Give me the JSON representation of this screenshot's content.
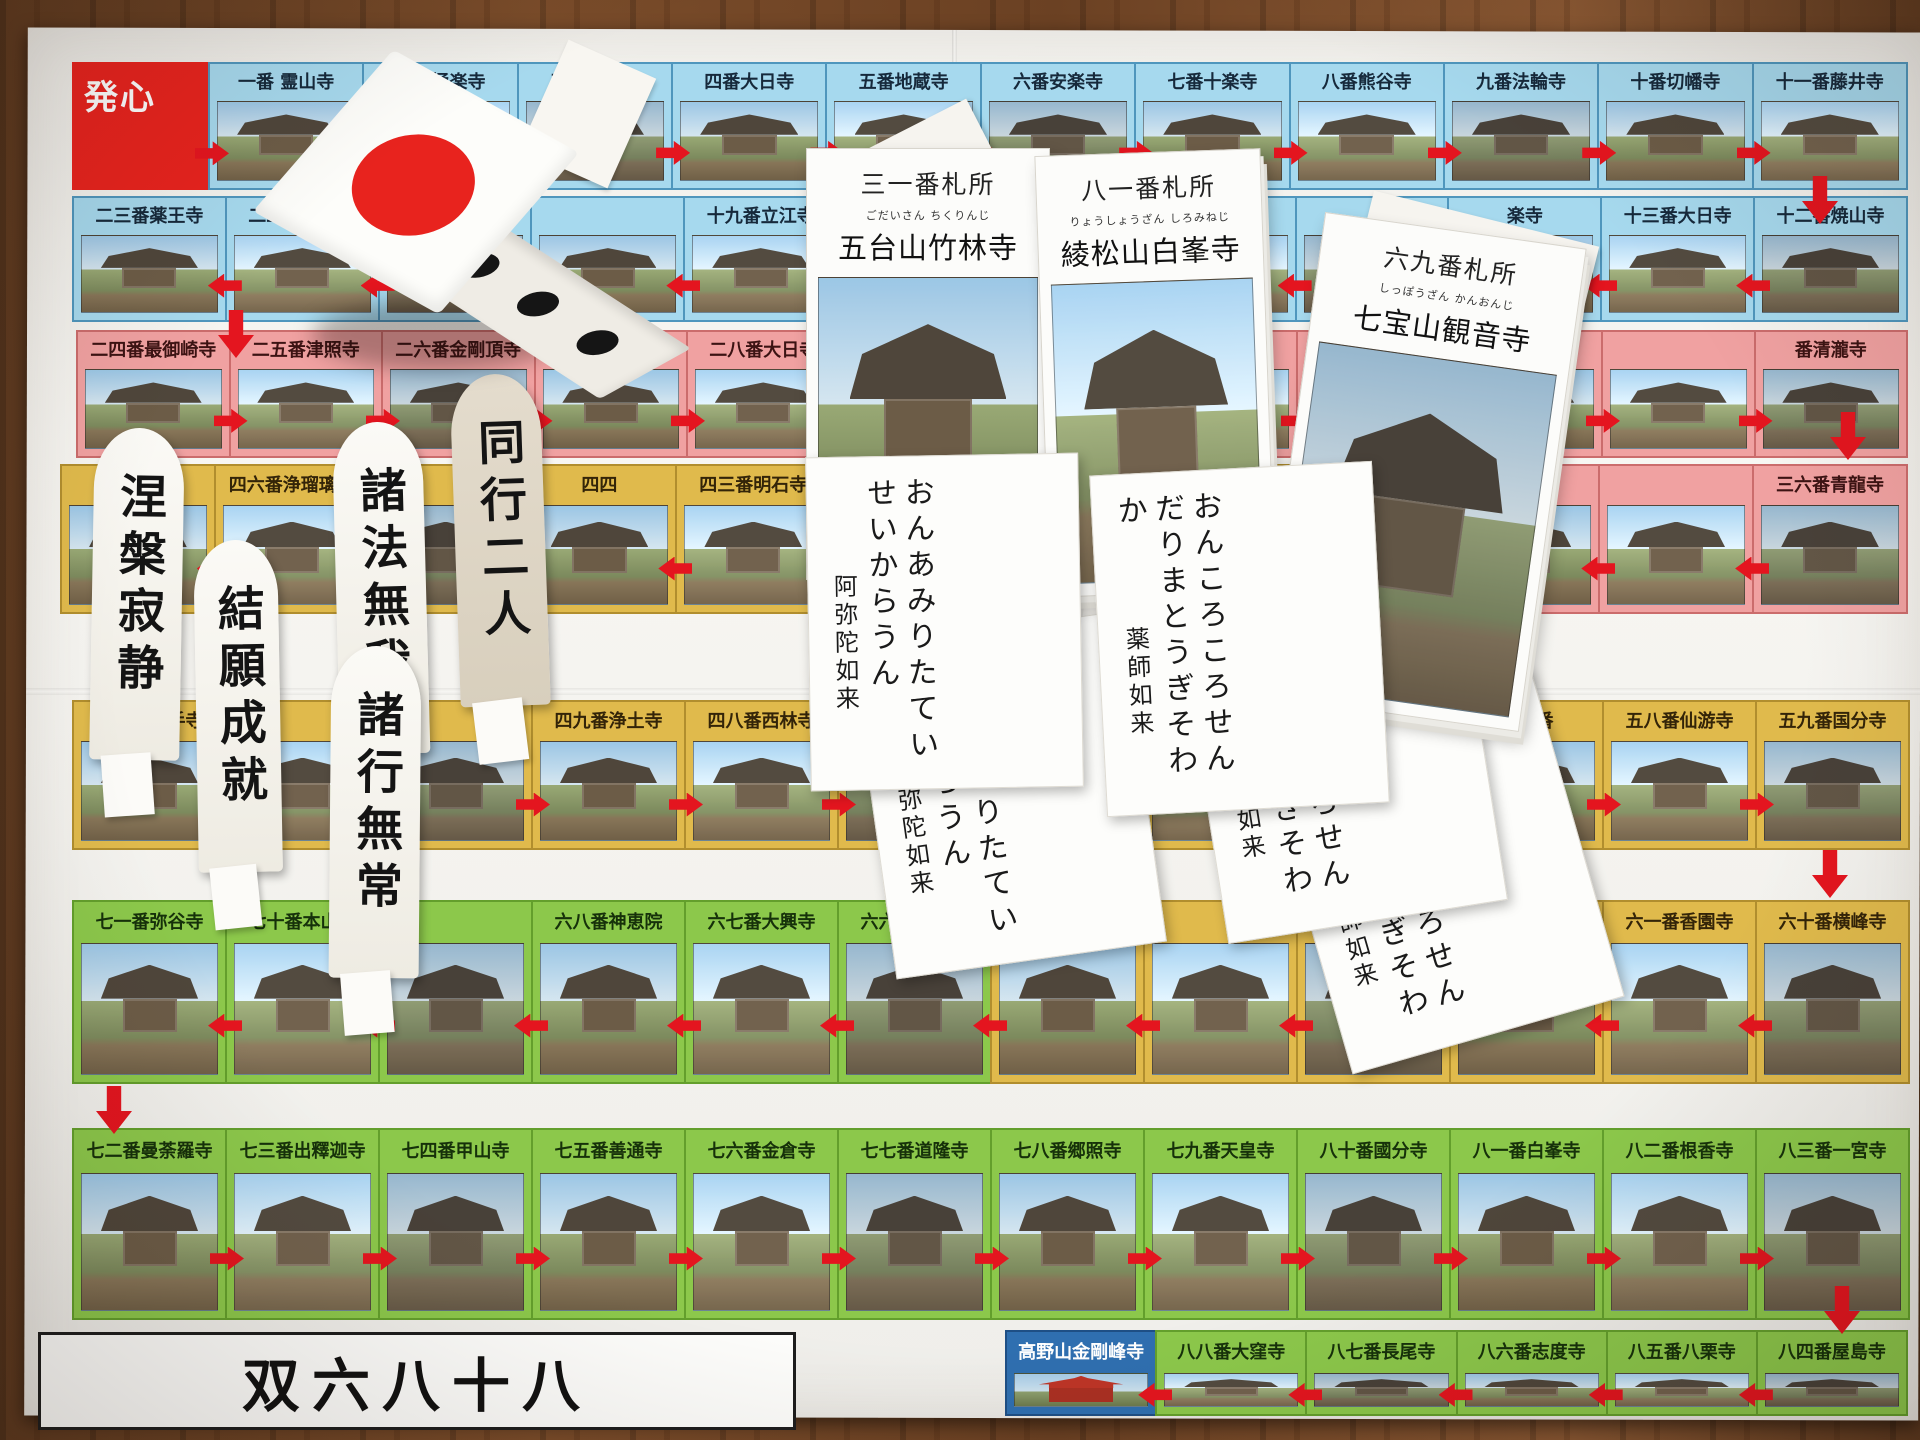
{
  "scene": {
    "board_title": "双六八十八",
    "start_label": "発心",
    "goal_label": "高野山金剛峰寺"
  },
  "rows": [
    {
      "name": "row-1",
      "zone": "blue",
      "dir": "right",
      "cells": [
        {
          "t": "一番 霊山寺"
        },
        {
          "t": "二番極楽寺"
        },
        {
          "t": "三番金泉寺"
        },
        {
          "t": "四番大日寺"
        },
        {
          "t": "五番地蔵寺"
        },
        {
          "t": "六番安楽寺"
        },
        {
          "t": "七番十楽寺"
        },
        {
          "t": "八番熊谷寺"
        },
        {
          "t": "九番法輪寺"
        },
        {
          "t": "十番切幡寺"
        },
        {
          "t": "十一番藤井寺"
        }
      ]
    },
    {
      "name": "row-2",
      "zone": "blue",
      "dir": "left",
      "cells": [
        {
          "t": "二三番薬王寺"
        },
        {
          "t": "二二番平等寺"
        },
        {
          "t": ""
        },
        {
          "t": ""
        },
        {
          "t": "十九番立江寺"
        },
        {
          "t": "十八番恩山寺"
        },
        {
          "t": ""
        },
        {
          "t": ""
        },
        {
          "t": ""
        },
        {
          "t": "楽寺"
        },
        {
          "t": "十三番大日寺"
        },
        {
          "t": "十二番焼山寺"
        }
      ]
    },
    {
      "name": "row-3",
      "zone": "pink",
      "dir": "right",
      "cells": [
        {
          "t": "二四番最御崎寺"
        },
        {
          "t": "二五番津照寺"
        },
        {
          "t": "二六番金剛頂寺"
        },
        {
          "t": "二七番神峯寺"
        },
        {
          "t": "二八番大日寺"
        },
        {
          "t": "二九番国分寺"
        },
        {
          "t": ""
        },
        {
          "t": ""
        },
        {
          "t": ""
        },
        {
          "t": ""
        },
        {
          "t": ""
        },
        {
          "t": "番清瀧寺"
        }
      ]
    },
    {
      "name": "row-4",
      "zone": "yellow",
      "dir": "left",
      "cells": [
        {
          "t": ""
        },
        {
          "t": "四六番浄瑠璃寺"
        },
        {
          "t": ""
        },
        {
          "t": "四四"
        },
        {
          "t": "四三番明石寺"
        },
        {
          "t": "四二番仏木寺"
        },
        {
          "t": "四一番龍光寺"
        },
        {
          "t": "四十番観自在寺"
        },
        {
          "t": "三九番延光寺",
          "z": "pink"
        },
        {
          "t": "三八番",
          "z": "pink"
        },
        {
          "t": "",
          "z": "pink"
        },
        {
          "t": "三六番青龍寺",
          "z": "pink"
        }
      ]
    },
    {
      "name": "row-5",
      "zone": "yellow",
      "dir": "right",
      "cells": [
        {
          "t": "五一番石手寺"
        },
        {
          "t": ""
        },
        {
          "t": ""
        },
        {
          "t": "四九番浄土寺"
        },
        {
          "t": "四八番西林寺"
        },
        {
          "t": "五二番太山寺"
        },
        {
          "t": "五三番圓明寺"
        },
        {
          "t": ""
        },
        {
          "t": "房"
        },
        {
          "t": "五六番"
        },
        {
          "t": "五八番仙游寺"
        },
        {
          "t": "五九番国分寺"
        }
      ]
    },
    {
      "name": "row-6",
      "zone": "green",
      "dir": "left",
      "cells": [
        {
          "t": "七一番弥谷寺"
        },
        {
          "t": "七十番本山寺"
        },
        {
          "t": ""
        },
        {
          "t": "六八番神恵院"
        },
        {
          "t": "六七番大興寺"
        },
        {
          "t": "六六番雲辺寺"
        },
        {
          "t": "",
          "z": "yellow"
        },
        {
          "t": "",
          "z": "yellow"
        },
        {
          "t": "六三",
          "z": "yellow"
        },
        {
          "t": "",
          "z": "yellow"
        },
        {
          "t": "六一番香園寺",
          "z": "yellow"
        },
        {
          "t": "六十番横峰寺",
          "z": "yellow"
        }
      ]
    },
    {
      "name": "row-7",
      "zone": "green",
      "dir": "right",
      "cells": [
        {
          "t": "七二番曼荼羅寺"
        },
        {
          "t": "七三番出釋迦寺"
        },
        {
          "t": "七四番甲山寺"
        },
        {
          "t": "七五番善通寺"
        },
        {
          "t": "七六番金倉寺"
        },
        {
          "t": "七七番道隆寺"
        },
        {
          "t": "七八番郷照寺"
        },
        {
          "t": "七九番天皇寺"
        },
        {
          "t": "八十番國分寺"
        },
        {
          "t": "八一番白峯寺"
        },
        {
          "t": "八二番根香寺"
        },
        {
          "t": "八三番一宮寺"
        }
      ]
    },
    {
      "name": "row-8",
      "zone": "green",
      "dir": "left",
      "cells": [
        {
          "t": "高野山金剛峰寺",
          "z": "goal"
        },
        {
          "t": "八八番大窪寺"
        },
        {
          "t": "八七番長尾寺"
        },
        {
          "t": "八六番志度寺"
        },
        {
          "t": "八五番八栗寺"
        },
        {
          "t": "八四番屋島寺"
        }
      ]
    }
  ],
  "cards": {
    "temple_cards": [
      {
        "header": "三一番札所",
        "furigana": "ごだいさん ちくりんじ",
        "name": "五台山竹林寺"
      },
      {
        "header": "八一番札所",
        "furigana": "りょうしょうざん しろみねじ",
        "name": "綾松山白峯寺"
      },
      {
        "header": "六九番札所",
        "furigana": "しっぽうざん かんおんじ",
        "name": "七宝山観音寺"
      }
    ],
    "mantra_cards": [
      {
        "line1": "おんあみりた",
        "line2": "ていせいからうん",
        "deity": "阿弥陀如来"
      },
      {
        "line1": "おんころころせんだり",
        "line2": "まとうぎそわか",
        "deity": "薬師如来"
      }
    ]
  },
  "standees": [
    "涅槃寂静",
    "結願成就",
    "諸法無我",
    "同行二人",
    "諸行無常"
  ],
  "die": {
    "top_face": "one-red-circle",
    "side_face": "three-pips"
  }
}
